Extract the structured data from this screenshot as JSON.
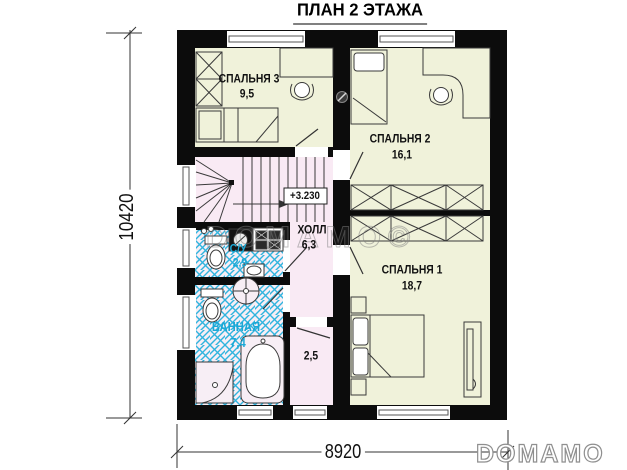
{
  "title": "ПЛАН 2 ЭТАЖА",
  "rooms": {
    "bedroom3": {
      "name": "СПАЛЬНЯ 3",
      "area": "9,5"
    },
    "bedroom2": {
      "name": "СПАЛЬНЯ 2",
      "area": "16,1"
    },
    "bedroom1": {
      "name": "СПАЛЬНЯ 1",
      "area": "18,7"
    },
    "hall": {
      "name": "ХОЛЛ",
      "area": "6,3"
    },
    "wc": {
      "name": "С/У",
      "area": "2,9"
    },
    "bathroom": {
      "name": "ВАННАЯ",
      "area": "7,4"
    },
    "storage": {
      "area": "2,5"
    }
  },
  "elevation": "+3.230",
  "dimensions": {
    "height": "10420",
    "width": "8920"
  },
  "watermark": "DOMAMO©",
  "brand": "DOMAMO",
  "colors": {
    "room_yellow": "#f0f2da",
    "room_pink": "#f9eaf4",
    "tile_bg": "#f7eef5",
    "tile_blue": "#2fb4de",
    "wall": "#0c0c0c",
    "wet_label": "#1ba8d6"
  }
}
